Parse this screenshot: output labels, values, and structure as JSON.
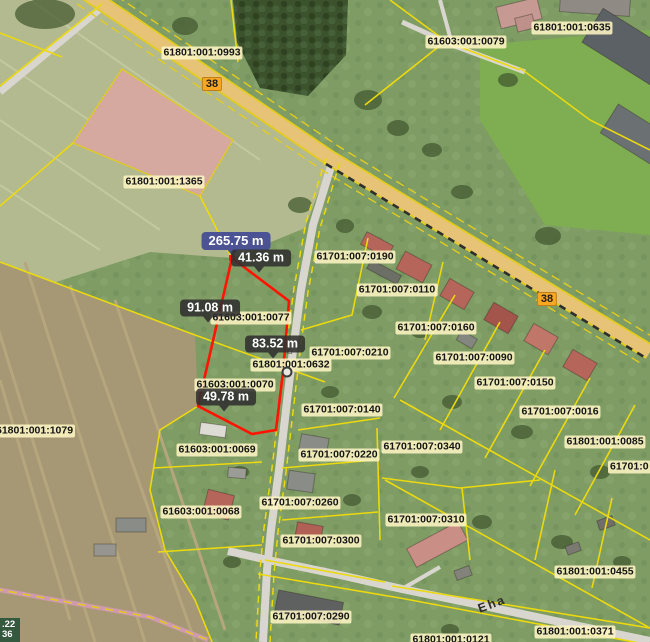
{
  "map": {
    "title": "cadastral-map-view",
    "coordinate_readout": {
      "line1": ".22",
      "line2": "36"
    },
    "colors": {
      "boundary_yellow": "#ecd90e",
      "highlight_red": "#fe1400",
      "label_bg": "rgba(253,245,195,0.88)",
      "label_text": "#141414",
      "measure_bg": "rgba(48,48,48,0.88)",
      "measure_primary_bg": "rgba(72,80,148,0.97)",
      "measure_text": "#ffffff",
      "road_badge_bg": "#f7a722",
      "road_badge_border": "#c07d18",
      "coord_bg": "rgba(42,84,58,0.92)",
      "coord_text": "#ffffff"
    },
    "parcel_labels": [
      {
        "text": "61801:001:0993",
        "x": 202,
        "y": 53
      },
      {
        "text": "61603:001:0079",
        "x": 466,
        "y": 42
      },
      {
        "text": "61801:001:0635",
        "x": 572,
        "y": 28
      },
      {
        "text": "61801:001:1365",
        "x": 164,
        "y": 182
      },
      {
        "text": "61603:001:0077",
        "x": 251,
        "y": 318
      },
      {
        "text": "61701:007:0190",
        "x": 355,
        "y": 257
      },
      {
        "text": "61701:007:0110",
        "x": 397,
        "y": 290
      },
      {
        "text": "61701:007:0160",
        "x": 436,
        "y": 328
      },
      {
        "text": "61701:007:0210",
        "x": 350,
        "y": 353
      },
      {
        "text": "61801:001:0632",
        "x": 291,
        "y": 365
      },
      {
        "text": "61701:007:0090",
        "x": 474,
        "y": 358
      },
      {
        "text": "61701:007:0150",
        "x": 515,
        "y": 383
      },
      {
        "text": "61603:001:0070",
        "x": 235,
        "y": 385
      },
      {
        "text": "61701:007:0140",
        "x": 342,
        "y": 410
      },
      {
        "text": "61701:007:0016",
        "x": 560,
        "y": 412
      },
      {
        "text": "61801:001:1079",
        "x": -6,
        "y": 431,
        "anchor": "left"
      },
      {
        "text": "61801:001:0085",
        "x": 605,
        "y": 442
      },
      {
        "text": "61701:007:0340",
        "x": 422,
        "y": 447
      },
      {
        "text": "61603:001:0069",
        "x": 217,
        "y": 450
      },
      {
        "text": "61701:007:0220",
        "x": 339,
        "y": 455
      },
      {
        "text": "61701:0",
        "x": 608,
        "y": 467,
        "anchor": "left"
      },
      {
        "text": "61701:007:0260",
        "x": 300,
        "y": 503
      },
      {
        "text": "61603:001:0068",
        "x": 201,
        "y": 512
      },
      {
        "text": "61701:007:0310",
        "x": 426,
        "y": 520
      },
      {
        "text": "61701:007:0300",
        "x": 321,
        "y": 541
      },
      {
        "text": "61801:001:0455",
        "x": 595,
        "y": 572
      },
      {
        "text": "61701:007:0290",
        "x": 311,
        "y": 617
      },
      {
        "text": "61801:001:0371",
        "x": 575,
        "y": 632
      },
      {
        "text": "61801:001:0121",
        "x": 451,
        "y": 640
      }
    ],
    "measurements": [
      {
        "text": "265.75 m",
        "x": 236,
        "y": 241,
        "style": "primary"
      },
      {
        "text": "41.36 m",
        "x": 261,
        "y": 258,
        "style": "dark"
      },
      {
        "text": "91.08 m",
        "x": 210,
        "y": 308,
        "style": "dark"
      },
      {
        "text": "83.52 m",
        "x": 275,
        "y": 344,
        "style": "dark"
      },
      {
        "text": "49.78 m",
        "x": 226,
        "y": 397,
        "style": "dark"
      }
    ],
    "road_badges": [
      {
        "text": "38",
        "x": 212,
        "y": 84
      },
      {
        "text": "38",
        "x": 547,
        "y": 299
      }
    ],
    "street_labels": [
      {
        "text": "Eha",
        "x": 492,
        "y": 604,
        "rotation": -20
      }
    ],
    "markers": [
      {
        "name": "poi-house-icon",
        "x": 290,
        "y": 352,
        "kind": "glyph",
        "glyph": "⌂"
      },
      {
        "name": "survey-point-icon",
        "x": 287,
        "y": 372,
        "kind": "ring"
      }
    ]
  }
}
